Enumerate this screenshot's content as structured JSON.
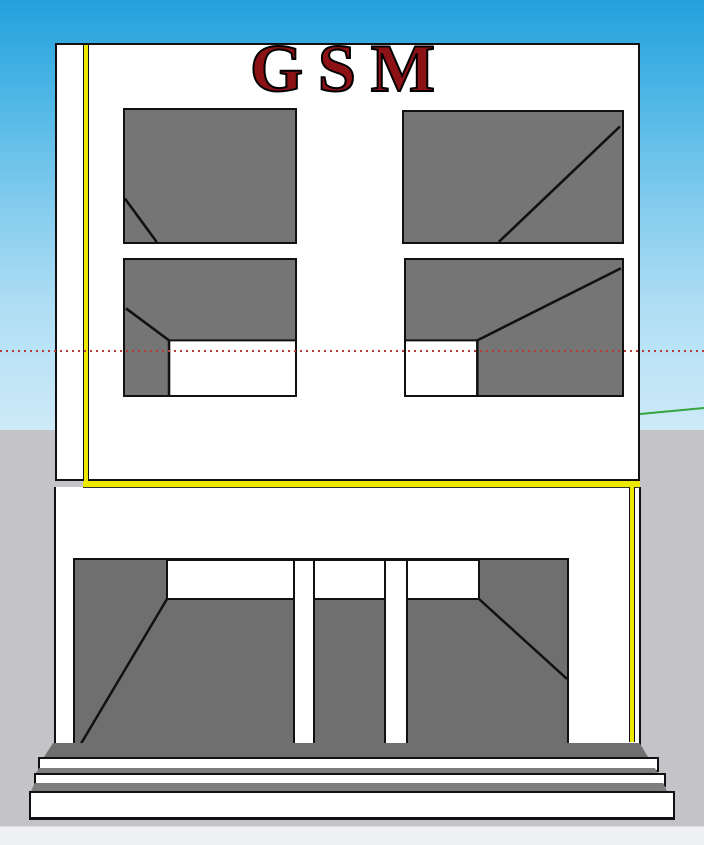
{
  "viewport": {
    "sign_text": "GSM"
  },
  "colors": {
    "sky_top": "#23a0dc",
    "sky_horizon": "#cdeaf8",
    "ground": "#c4c4c8",
    "status_strip": "#eef0f4",
    "facade": "#ffffff",
    "outline": "#111111",
    "window_gray": "#757575",
    "interior_gray": "#6f6f6f",
    "step_tread_gray": "#7e7e7e",
    "trim_yellow": "#ece800",
    "sign_red": "#8c1216",
    "axis_red": "#bb3a3a",
    "axis_green": "#33a63e"
  }
}
